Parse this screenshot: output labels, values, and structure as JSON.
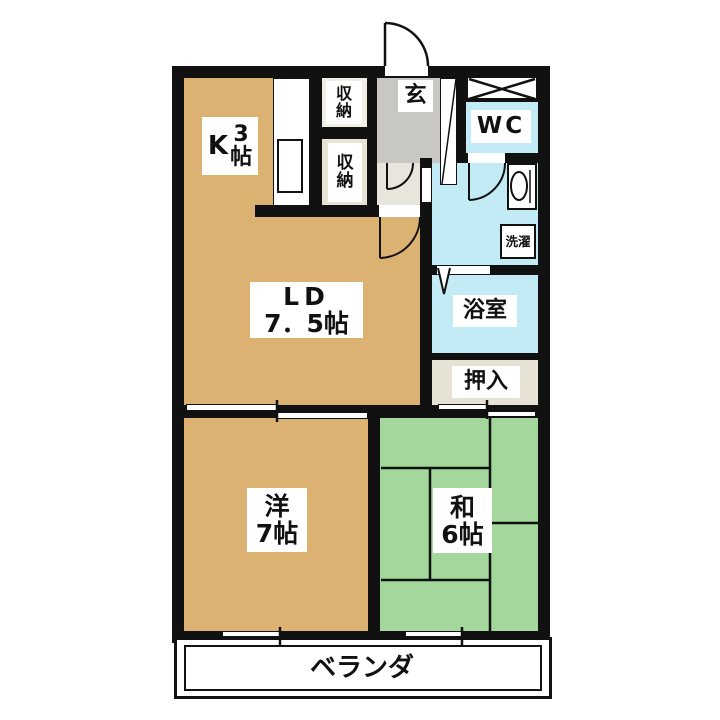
{
  "colors": {
    "wall": "#111111",
    "room_tan": "#dcb272",
    "tatami_green": "#a3d79c",
    "water_blue": "#c2ebf5",
    "genkan_gray": "#c8c7c3",
    "hall_beige": "#e8e6dc",
    "closet_beige": "#e6e3d4",
    "closet_light": "#f1eee4",
    "label_white": "#ffffff"
  },
  "rooms": {
    "kitchen": {
      "name": "K",
      "size": "3",
      "unit": "帖"
    },
    "living_dining": {
      "name": "LD",
      "size": "7．5帖"
    },
    "western_room": {
      "name": "洋",
      "size": "7帖"
    },
    "japanese_room": {
      "name": "和",
      "size": "6帖"
    },
    "wc": {
      "name": "WC"
    },
    "bathroom": {
      "name": "浴室"
    },
    "oshiire_closet": {
      "name": "押入"
    },
    "entrance": {
      "name": "玄"
    },
    "storage_upper": {
      "name": "収納"
    },
    "storage_lower": {
      "name": "収納"
    },
    "laundry": {
      "name": "洗濯"
    },
    "veranda": {
      "name": "ベランダ"
    }
  }
}
